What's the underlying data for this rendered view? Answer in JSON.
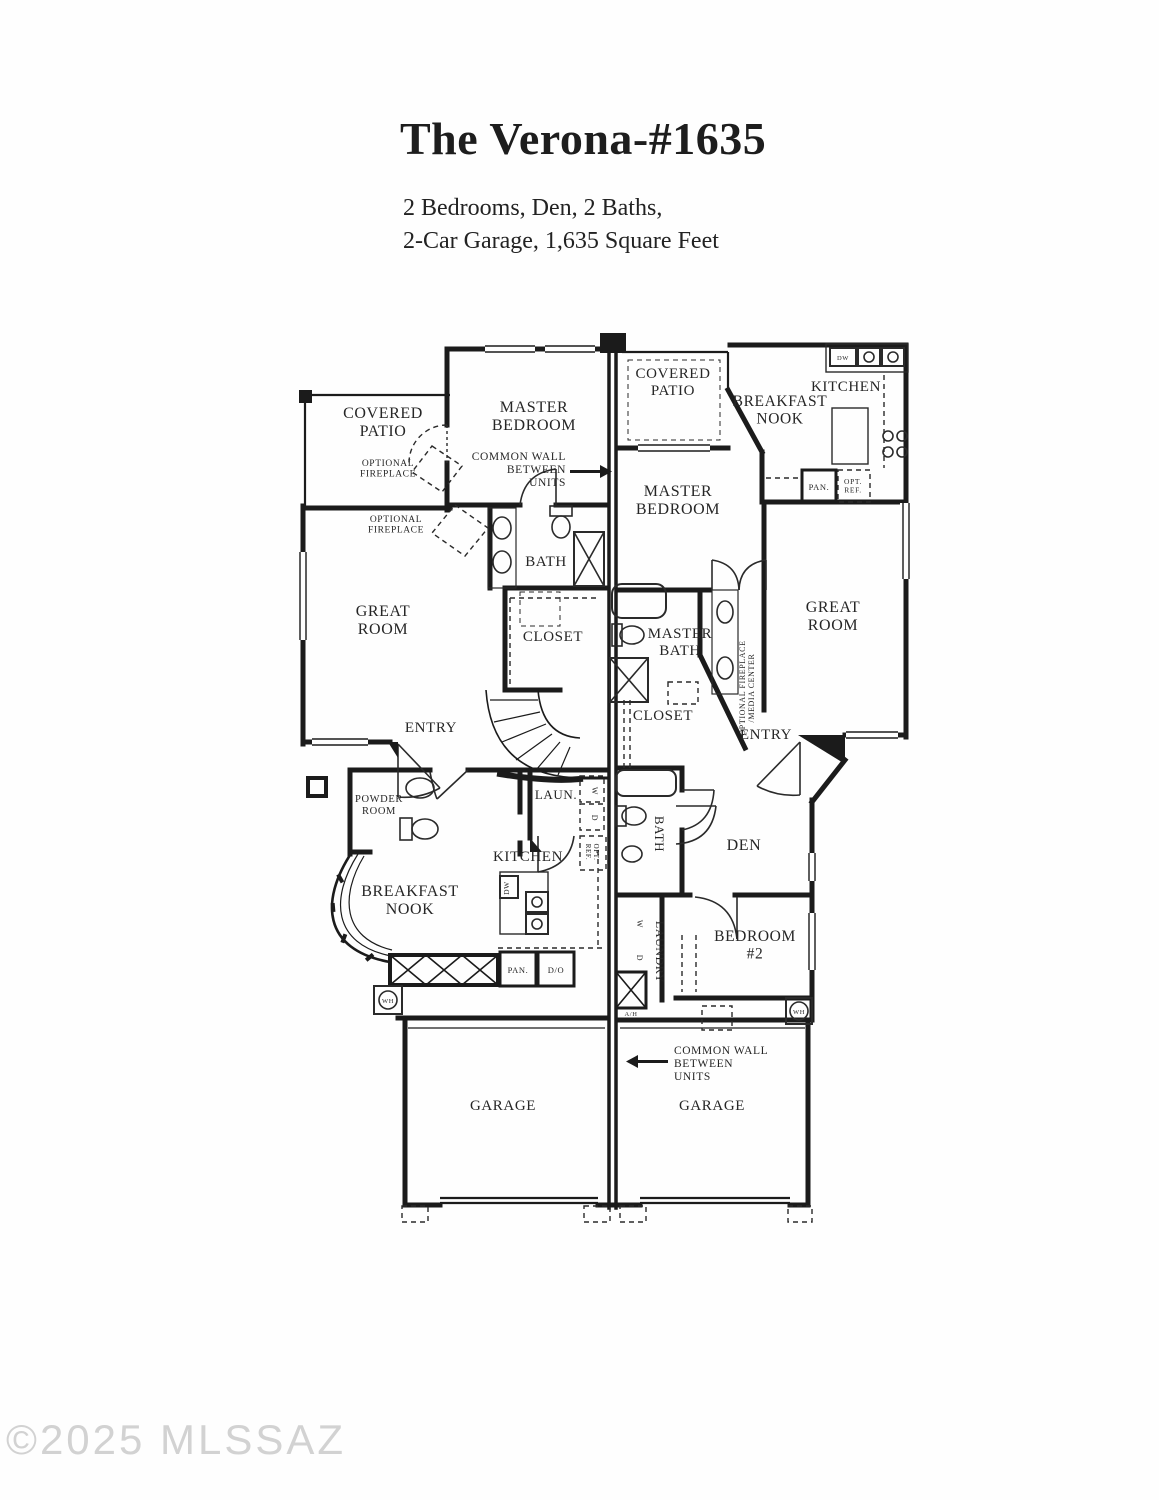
{
  "header": {
    "title": "The Verona-#1635",
    "subtitle_line1": "2 Bedrooms, Den, 2 Baths,",
    "subtitle_line2": "2-Car Garage, 1,635 Square Feet"
  },
  "watermark": "©2025 MLSSAZ",
  "colors": {
    "wall": "#1b1b1b",
    "label": "#262626",
    "watermark": "#d2d2d2",
    "background": "#fefefe"
  },
  "floorplan": {
    "labels": {
      "left_covered_patio": "COVERED\nPATIO",
      "left_optional_fireplace_upper": "OPTIONAL\nFIREPLACE",
      "left_optional_fireplace_lower": "OPTIONAL\nFIREPLACE",
      "left_master_bedroom": "MASTER\nBEDROOM",
      "common_wall_top": "COMMON WALL\nBETWEEN\nUNITS",
      "left_bath": "BATH",
      "left_great_room": "GREAT\nROOM",
      "left_closet": "CLOSET",
      "left_entry": "ENTRY",
      "left_powder_room": "POWDER\nROOM",
      "left_laundry": "LAUN.",
      "left_washer": "W",
      "left_dryer": "D",
      "left_opt_ref": "OPT.\nREF.",
      "left_kitchen": "KITCHEN",
      "left_dw": "DW",
      "left_breakfast_nook": "BREAKFAST\nNOOK",
      "left_pan": "PAN.",
      "left_do": "D/O",
      "left_wh": "WH",
      "left_garage": "GARAGE",
      "right_covered_patio": "COVERED\nPATIO",
      "right_breakfast_nook": "BREAKFAST\nNOOK",
      "right_kitchen": "KITCHEN",
      "right_dw": "DW",
      "right_master_bedroom": "MASTER\nBEDROOM",
      "right_pan": "PAN.",
      "right_opt_ref": "OPT.\nREF.",
      "right_master_bath": "MASTER\nBATH",
      "right_opt_fireplace_media": "OPTIONAL FIREPLACE\n/MEDIA CENTER",
      "right_great_room": "GREAT\nROOM",
      "right_closet": "CLOSET",
      "right_entry": "ENTRY",
      "right_bath": "BATH",
      "right_den": "DEN",
      "right_laundry": "LAUNDRY",
      "right_washer": "W",
      "right_dryer": "D",
      "right_bedroom2": "BEDROOM\n#2",
      "right_ah": "A/H",
      "right_wh": "WH",
      "common_wall_bottom": "COMMON WALL\nBETWEEN\nUNITS",
      "right_garage": "GARAGE"
    }
  }
}
